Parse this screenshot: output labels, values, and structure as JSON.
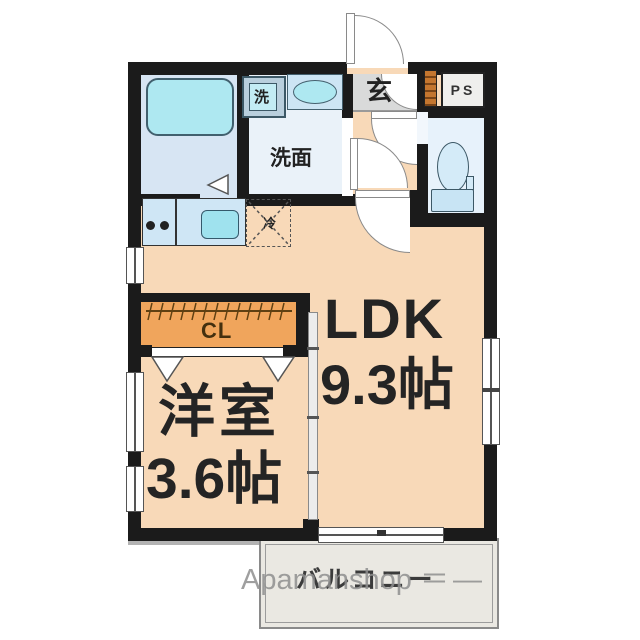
{
  "plan": {
    "labels": {
      "entrance": "玄",
      "pipe_space": "PS",
      "washer": "洗",
      "washroom": "洗面",
      "fridge": "冷",
      "ldk_name": "LDK",
      "ldk_size": "9.3帖",
      "western_name": "洋室",
      "western_size": "3.6帖",
      "closet": "CL",
      "balcony": "バルコニー",
      "watermark": "Apamanshop",
      "watermark_marks": "＝ —"
    },
    "colors": {
      "wall": "#1b1b1b",
      "floor_main": "#f8d9b8",
      "bath_floor": "#d7e5f3",
      "washroom_floor": "#eaf2f9",
      "toilet_floor": "#e7f2fb",
      "entrance_floor": "#d9dada",
      "closet_orange": "#f0a55c",
      "shoe_cabinet_orange": "#c4762f",
      "fixture_cyan": "#aee8f1",
      "fixture_light_blue": "#cde5f4",
      "counter_blue": "#cfe6f5",
      "balcony_fill": "#eae8e2",
      "watermark_gray": "#8f8f8f",
      "door_line_gray": "#8a8a8a",
      "text_dark": "#222222"
    }
  }
}
